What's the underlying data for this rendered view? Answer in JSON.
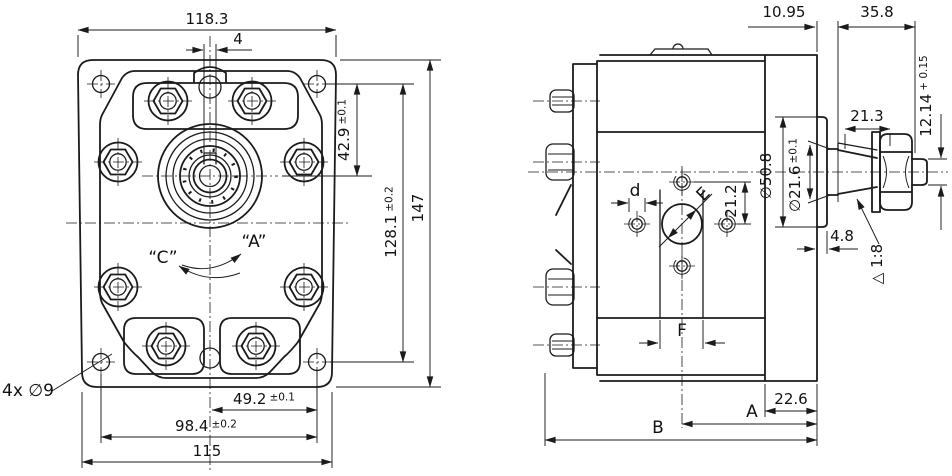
{
  "colors": {
    "line": "#1b1b1b",
    "background": "#ffffff"
  },
  "front_view": {
    "dim_flange_width_top": "118.3",
    "dim_keyway_width": "4",
    "dim_axis_height": "42.9",
    "dim_axis_height_tol": "±0.1",
    "dim_bolt_vpitch": "128.1",
    "dim_bolt_vpitch_tol": "±0.2",
    "dim_flange_height": "147",
    "label_mount_holes": "4x ∅9",
    "dim_bolt_half_pitch": "49.2",
    "dim_bolt_half_pitch_tol": "±0.1",
    "dim_bolt_hpitch": "98.4",
    "dim_bolt_hpitch_tol": "±0.2",
    "dim_flange_width_bottom": "115",
    "label_rotation_cw": "“A”",
    "label_rotation_ccw": "“C”"
  },
  "side_view": {
    "dim_face_to_taper": "10.95",
    "dim_shaft_length": "35.8",
    "dim_key_length": "21.3",
    "dim_thread_size": "12.14",
    "dim_thread_size_tol": "+ 0.15",
    "dim_spigot_dia": "∅50.8",
    "dim_shaft_dia": "∅21.6",
    "dim_shaft_dia_tol": "±0.1",
    "dim_port_hole_offset": "21.2",
    "ref_port_thread": "d",
    "ref_port_dia": "E",
    "dim_spigot_depth": "4.8",
    "label_taper": "△ 1:8",
    "ref_port_pitch": "F",
    "dim_flange_thickness": "22.6",
    "ref_length_a": "A",
    "ref_length_b": "B"
  }
}
